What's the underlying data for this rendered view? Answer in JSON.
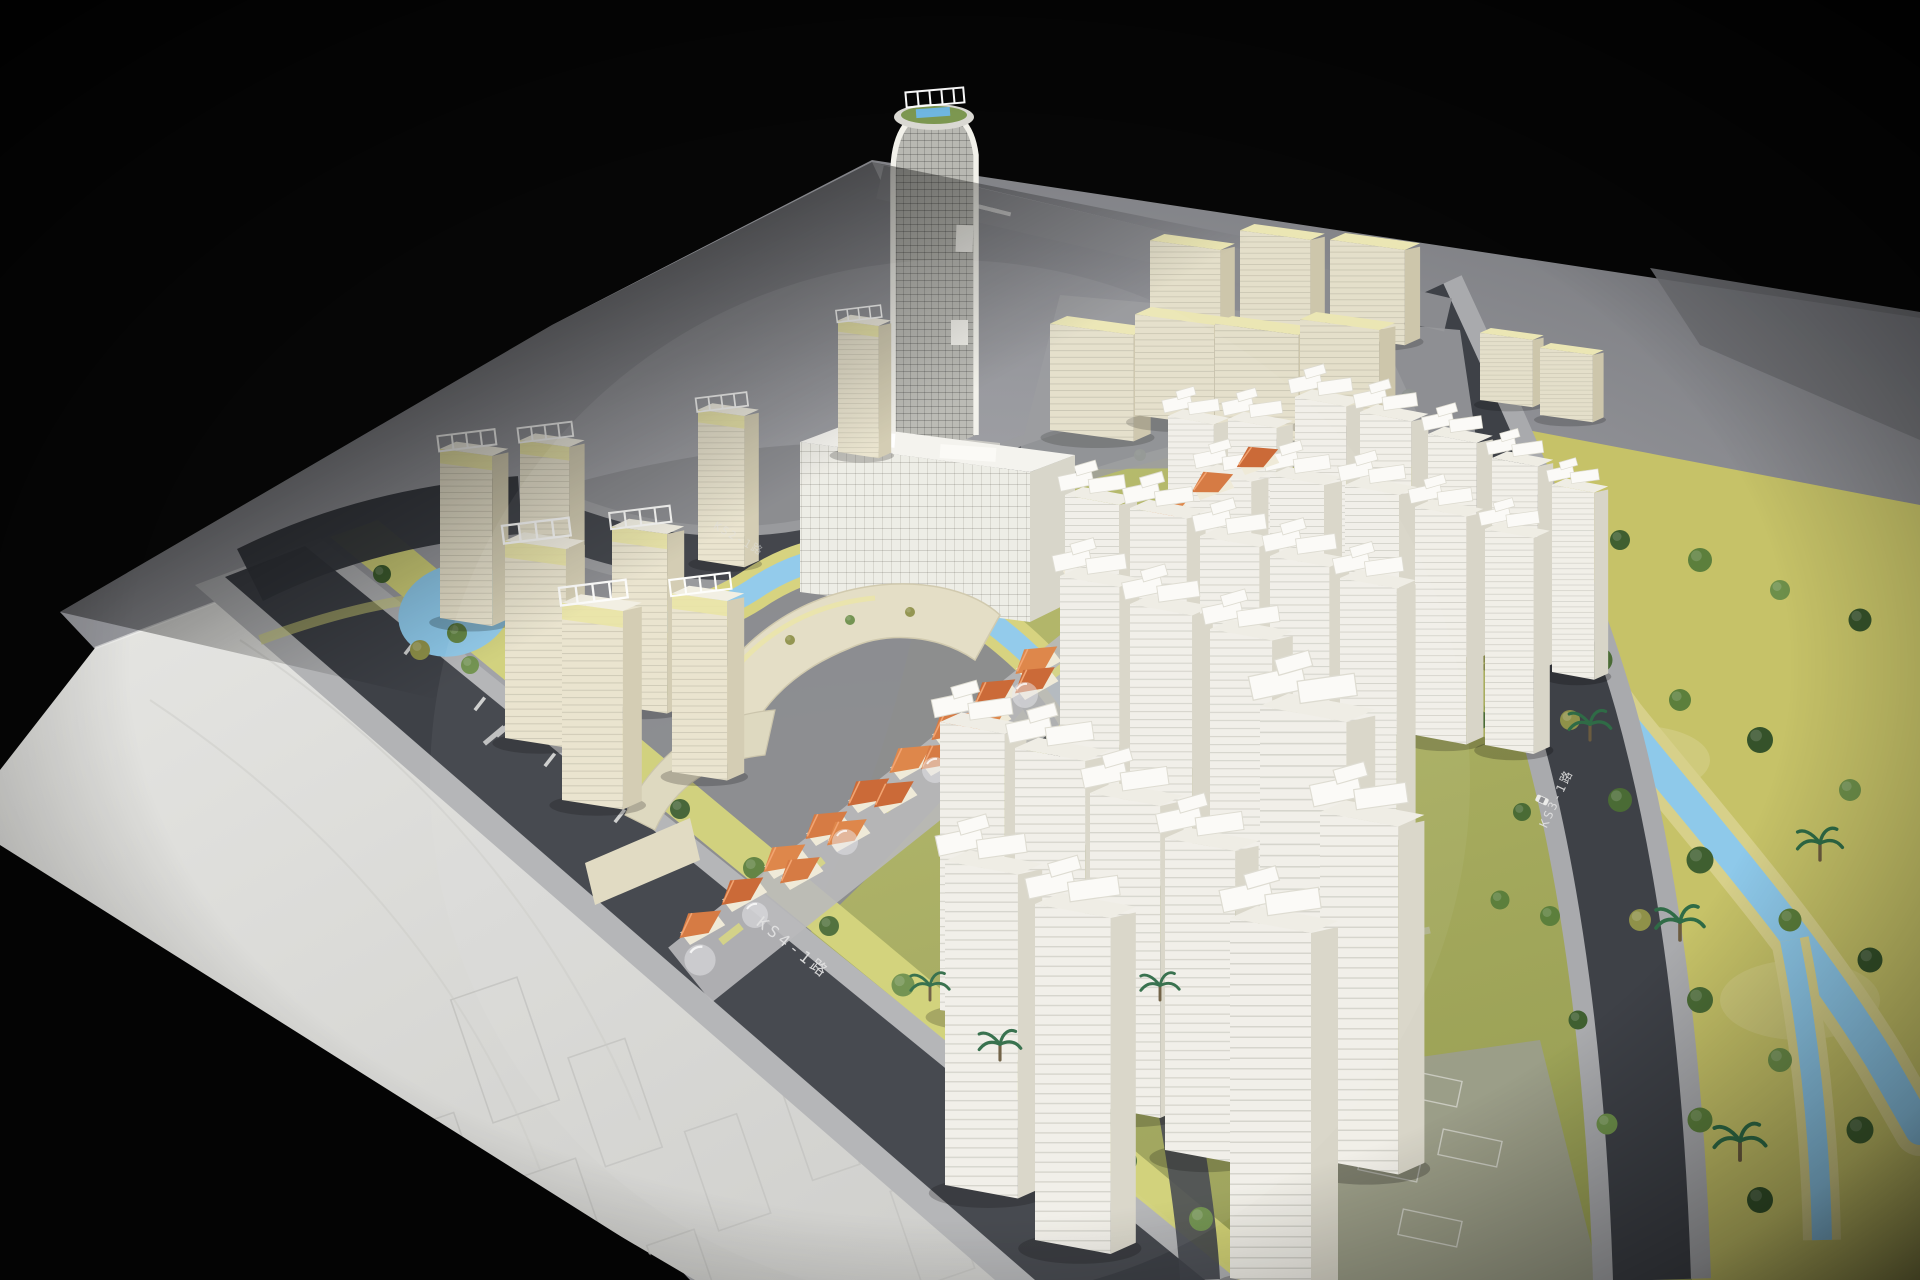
{
  "scene": {
    "kind": "photograph-of-architectural-scale-model",
    "description": "Aerial oblique view of a physical urban master-plan scale model lit in a dark studio: white residential towers with slab crowns, a rounded landmark skyscraper, cream office blocks, orange-roofed shophouse street, canals, and a tree-filled park, on a gray baseboard with an engraved white future-phase plate."
  },
  "labels": {
    "ks4": "KS4-1路",
    "ks3": "KS3-1路",
    "ks2": "KS2-1路"
  },
  "colors": {
    "background": "#060606",
    "board": "#9a9b9f",
    "board_bright": "#b4b5b8",
    "plate": "#dcdcd9",
    "road": "#3e4147",
    "road_lit": "#4c4f55",
    "sidewalk": "#b2b3b5",
    "verge": "#d3d377",
    "park": "#c6c268",
    "water": "#8ec9ea",
    "tree_dark": "#3f5f30",
    "tree_mid": "#5c7f3c",
    "tree_light": "#6d8f4a",
    "tree_olive": "#8f9149",
    "palm": "#2f6b46",
    "bldg_white": "#f1efe8",
    "bldg_white_side": "#d8d5c8",
    "bldg_cream": "#e9e3cd",
    "bldg_cream_side": "#d2cbb0",
    "roof_pale": "#ece7b4",
    "roof_orange": "#d4743a",
    "cap_white": "#fbfaf7",
    "landmark": "#b8b8b2",
    "label_text": "#e2e2e2"
  }
}
